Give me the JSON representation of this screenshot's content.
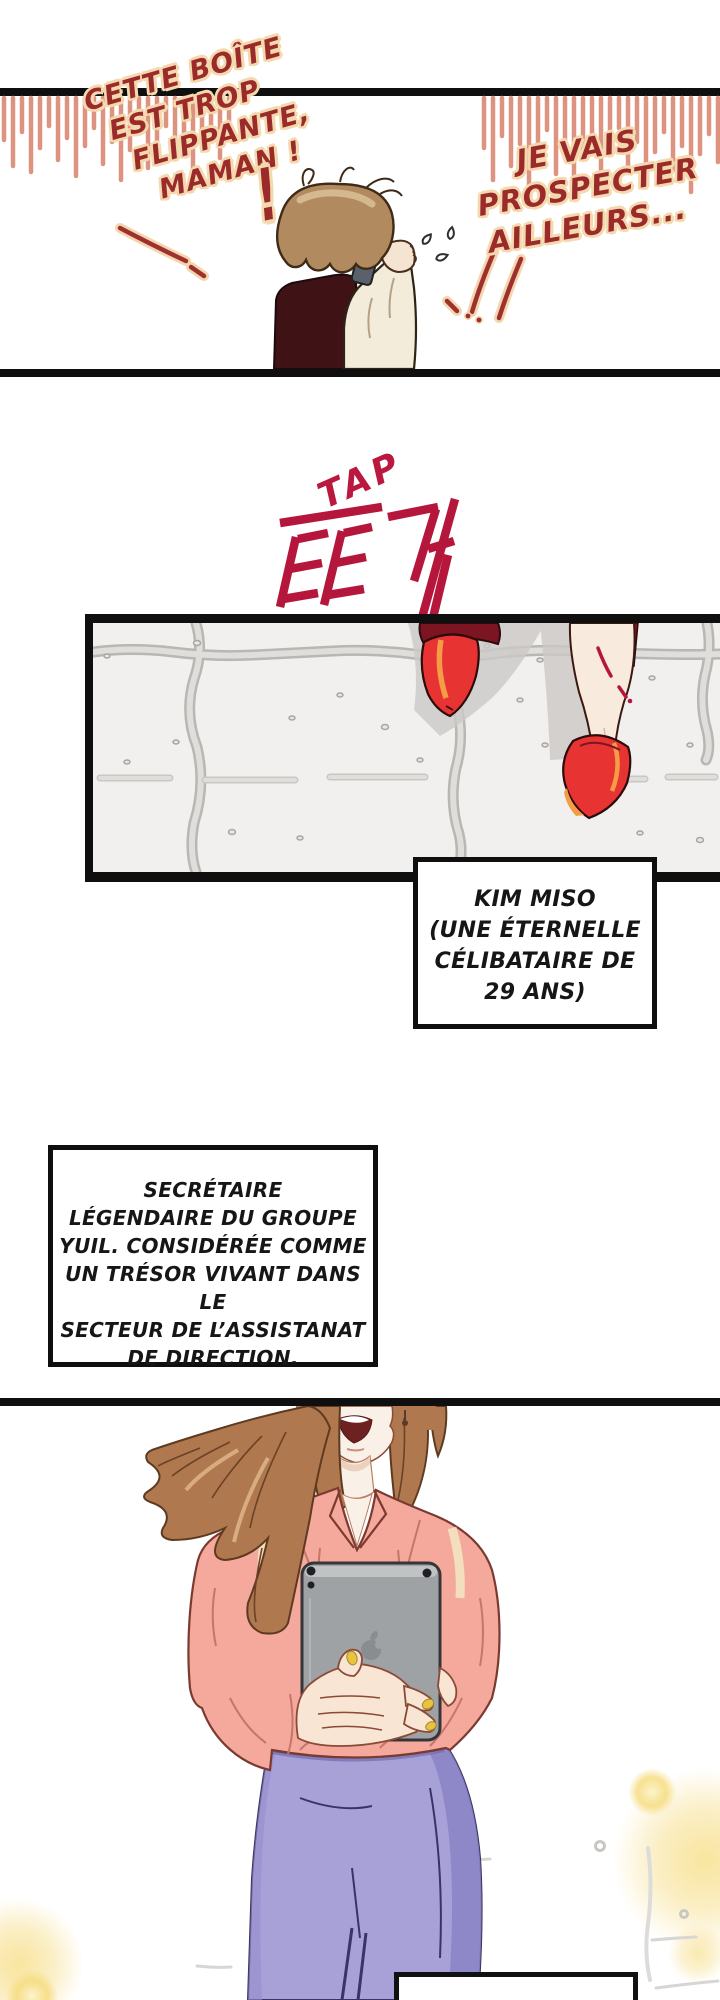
{
  "comic": {
    "panel1": {
      "speech_left": {
        "lines": [
          "CETTE BOÎTE",
          "EST TROP",
          "FLIPPANTE,",
          "MAMAN !"
        ]
      },
      "big_exclamation": "!",
      "speech_right": {
        "lines": [
          "JE VAIS",
          "PROSPECTER",
          "AILLEURS..."
        ]
      }
    },
    "sfx": {
      "translit": "TAP",
      "korean": "또각"
    },
    "captions": {
      "kim_miso": {
        "lines": [
          "KIM MISO",
          "(UNE ÉTERNELLE",
          "CÉLIBATAIRE DE",
          "29 ANS)"
        ]
      },
      "bio": {
        "lines": [
          "SECRÉTAIRE",
          "LÉGENDAIRE DU GROUPE",
          "YUIL. CONSIDÉRÉE COMME",
          "UN TRÉSOR VIVANT DANS LE",
          "SECTEUR DE L’ASSISTANAT",
          "DE DIRECTION."
        ]
      },
      "bottom_partial": {
        "text": ""
      }
    },
    "colors": {
      "speech_red": "#9B2A2A",
      "outline_cream": "#F4D9AE",
      "sfx_crimson": "#BB1840",
      "fringe_pink": "#DE9280",
      "heel_red": "#E73331",
      "heel_orange": "#F59C47",
      "skirt_lavender": "#A7A1D8",
      "blouse_pink": "#F4A99C",
      "hair_brown": "#B0784F",
      "bokeh_yellow": "#F7DF8E",
      "panel_ink": "#0F0F0F"
    }
  }
}
